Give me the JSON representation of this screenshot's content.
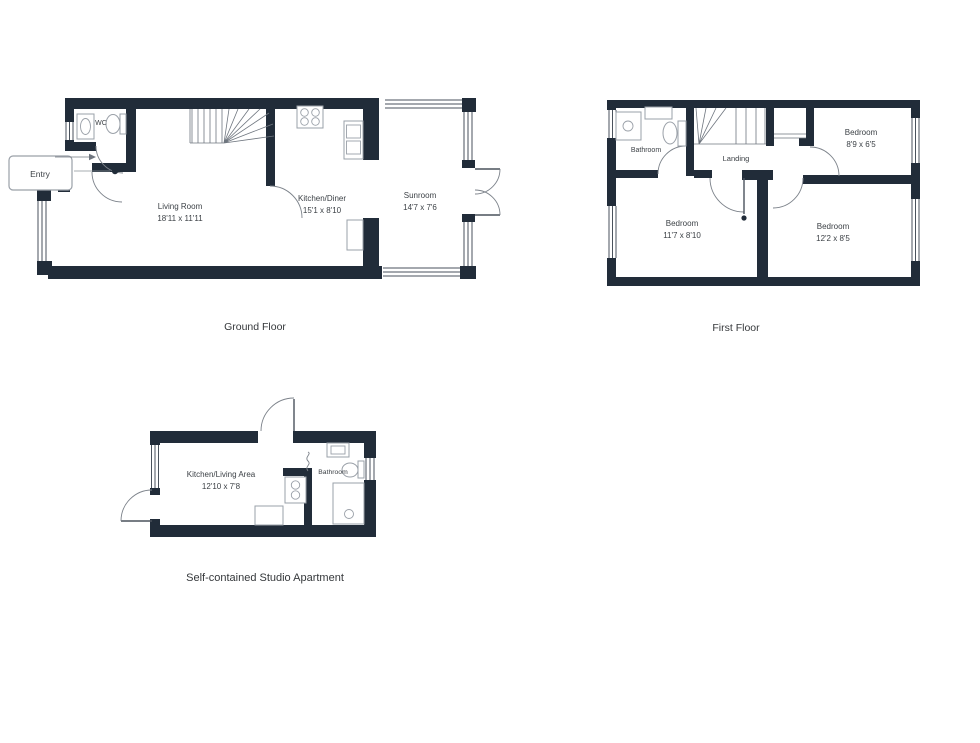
{
  "document": {
    "type": "floorplan-sheet",
    "background": "#ffffff"
  },
  "colors": {
    "wall": "#212c39",
    "window_line": "#4a525c",
    "fixture_line": "#9aa0a8",
    "text": "#3c4146"
  },
  "ground_floor": {
    "caption": "Ground Floor",
    "rooms": {
      "wc": {
        "name": "WC"
      },
      "entry": {
        "label": "Entry"
      },
      "living_room": {
        "name": "Living Room",
        "dimensions": "18'11 x 11'11"
      },
      "kitchen_diner": {
        "name": "Kitchen/Diner",
        "dimensions": "15'1 x 8'10"
      },
      "sunroom": {
        "name": "Sunroom",
        "dimensions": "14'7 x 7'6"
      }
    }
  },
  "first_floor": {
    "caption": "First Floor",
    "rooms": {
      "bathroom": {
        "name": "Bathroom"
      },
      "landing": {
        "name": "Landing"
      },
      "bedroom_top_right": {
        "name": "Bedroom",
        "dimensions": "8'9 x 6'5"
      },
      "bedroom_bottom_left": {
        "name": "Bedroom",
        "dimensions": "11'7 x 8'10"
      },
      "bedroom_bottom_right": {
        "name": "Bedroom",
        "dimensions": "12'2 x 8'5"
      }
    }
  },
  "studio": {
    "caption": "Self-contained Studio Apartment",
    "rooms": {
      "kitchen_living": {
        "name": "Kitchen/Living Area",
        "dimensions": "12'10 x 7'8"
      },
      "bathroom": {
        "name": "Bathroom"
      }
    }
  }
}
